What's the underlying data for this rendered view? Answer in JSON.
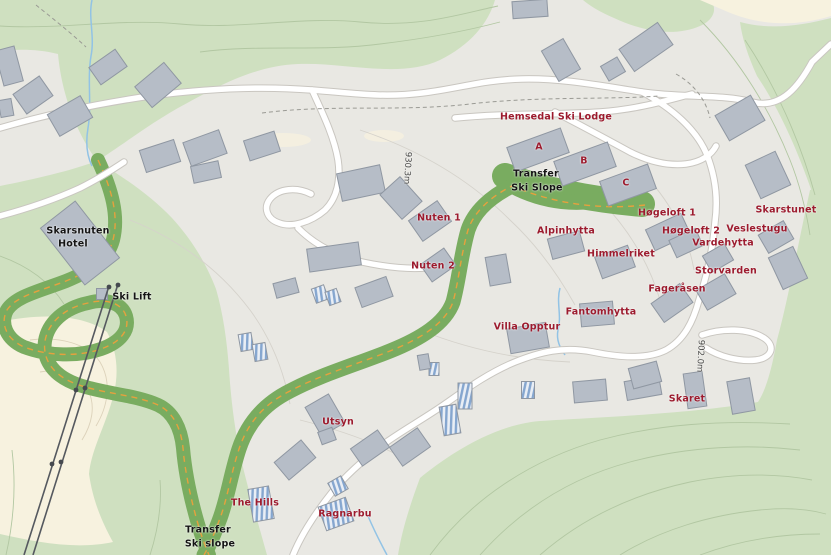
{
  "map": {
    "type": "ski-resort-site-map",
    "area_name": "Hemsedal Ski Lodge / Skarsnuten area",
    "colors": {
      "background": "#e9e8e3",
      "forest": "#cfe0c0",
      "open_land": "#f7f2df",
      "ski_slope": "#79ac60",
      "slope_dash": "#e5a13e",
      "road_fill": "#ffffff",
      "road_casing": "#c9c6c0",
      "building": "#b6bdc7",
      "building_stroke": "#8f97a2",
      "building_stripe": "#85a6cf",
      "water": "#92c3e5",
      "lift_line": "#55595f",
      "contour_green": "#b2c7a2",
      "contour_gray": "#d5d2cb",
      "contour_beige": "#dcd2ba",
      "label_red": "#9c1b2e",
      "label_black": "#141414"
    },
    "labels": [
      {
        "id": "hemsedal-ski-lodge",
        "text": "Hemsedal Ski Lodge",
        "x": 556,
        "y": 117,
        "style": "red"
      },
      {
        "id": "lodge-building-a",
        "text": "A",
        "x": 539,
        "y": 147,
        "style": "red"
      },
      {
        "id": "lodge-building-b",
        "text": "B",
        "x": 584,
        "y": 161,
        "style": "red"
      },
      {
        "id": "lodge-building-c",
        "text": "C",
        "x": 626,
        "y": 183,
        "style": "red"
      },
      {
        "id": "transfer-ski-slope-upper-line1",
        "text": "Transfer",
        "x": 536,
        "y": 174,
        "style": "black"
      },
      {
        "id": "transfer-ski-slope-upper-line2",
        "text": "Ski Slope",
        "x": 537,
        "y": 188,
        "style": "black"
      },
      {
        "id": "nuten-1",
        "text": "Nuten 1",
        "x": 439,
        "y": 218,
        "style": "red"
      },
      {
        "id": "nuten-2",
        "text": "Nuten 2",
        "x": 433,
        "y": 266,
        "style": "red"
      },
      {
        "id": "alpinhytta",
        "text": "Alpinhytta",
        "x": 566,
        "y": 231,
        "style": "red"
      },
      {
        "id": "himmelriket",
        "text": "Himmelriket",
        "x": 621,
        "y": 254,
        "style": "red"
      },
      {
        "id": "hogeloft-1",
        "text": "Høgeloft 1",
        "x": 667,
        "y": 213,
        "style": "red"
      },
      {
        "id": "hogeloft-2",
        "text": "Høgeloft 2",
        "x": 691,
        "y": 231,
        "style": "red"
      },
      {
        "id": "skarstunet",
        "text": "Skarstunet",
        "x": 786,
        "y": 210,
        "style": "red"
      },
      {
        "id": "veslestugu",
        "text": "Veslestugu",
        "x": 757,
        "y": 229,
        "style": "red"
      },
      {
        "id": "vardehytta",
        "text": "Vardehytta",
        "x": 723,
        "y": 243,
        "style": "red"
      },
      {
        "id": "storvarden",
        "text": "Storvarden",
        "x": 726,
        "y": 271,
        "style": "red"
      },
      {
        "id": "fagerasen",
        "text": "Fageråsen",
        "x": 677,
        "y": 289,
        "style": "red"
      },
      {
        "id": "fantomhytta",
        "text": "Fantomhytta",
        "x": 601,
        "y": 312,
        "style": "red"
      },
      {
        "id": "villa-opptur",
        "text": "Villa Opptur",
        "x": 527,
        "y": 327,
        "style": "red"
      },
      {
        "id": "skaret",
        "text": "Skaret",
        "x": 687,
        "y": 399,
        "style": "red"
      },
      {
        "id": "utsyn",
        "text": "Utsyn",
        "x": 338,
        "y": 422,
        "style": "red"
      },
      {
        "id": "the-hills",
        "text": "The Hills",
        "x": 255,
        "y": 503,
        "style": "red"
      },
      {
        "id": "ragnarbu",
        "text": "Ragnarbu",
        "x": 345,
        "y": 514,
        "style": "red"
      },
      {
        "id": "skarsnuten-hotel-line1",
        "text": "Skarsnuten",
        "x": 78,
        "y": 231,
        "style": "black"
      },
      {
        "id": "skarsnuten-hotel-line2",
        "text": "Hotel",
        "x": 73,
        "y": 244,
        "style": "black"
      },
      {
        "id": "ski-lift",
        "text": "Ski Lift",
        "x": 132,
        "y": 297,
        "style": "black"
      },
      {
        "id": "transfer-ski-slope-bottom-line1",
        "text": "Transfer",
        "x": 208,
        "y": 530,
        "style": "black"
      },
      {
        "id": "transfer-ski-slope-bottom-line2",
        "text": "Ski slope",
        "x": 210,
        "y": 544,
        "style": "black"
      },
      {
        "id": "elevation-930-3m",
        "text": "930.3m",
        "x": 407,
        "y": 168,
        "style": "elev",
        "vertical": true
      },
      {
        "id": "elevation-902-0m",
        "text": "902.0m",
        "x": 700,
        "y": 356,
        "style": "elev",
        "vertical": true
      }
    ]
  }
}
